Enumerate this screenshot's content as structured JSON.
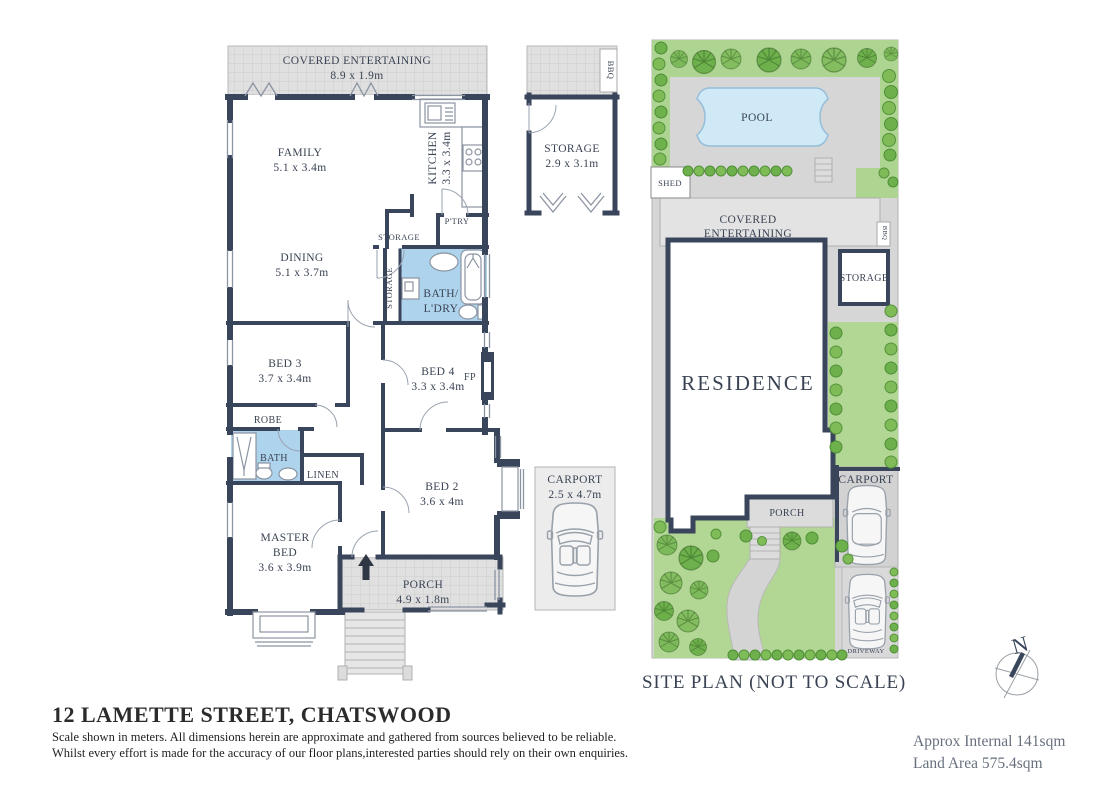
{
  "meta": {
    "address_title": "12 LAMETTE STREET, CHATSWOOD",
    "disclaimer_line1": "Scale shown in meters. All dimensions herein are approximate and gathered from sources believed to be reliable.",
    "disclaimer_line2": "Whilst every effort is made for the accuracy of our floor plans,interested parties should rely on their own enquiries.",
    "approx_internal": "Approx Internal 141sqm",
    "land_area": "Land Area 575.4sqm",
    "compass_north": "N"
  },
  "floorplan": {
    "covered_entertaining": {
      "name": "COVERED ENTERTAINING",
      "dims": "8.9 x 1.9m"
    },
    "family": {
      "name": "FAMILY",
      "dims": "5.1 x 3.4m"
    },
    "kitchen": {
      "name": "KITCHEN",
      "dims": "3.3 x 3.4m"
    },
    "pantry": {
      "name": "P'TRY"
    },
    "storage_hall": {
      "name": "STORAGE"
    },
    "storage_passage": {
      "name": "STORAGE"
    },
    "dining": {
      "name": "DINING",
      "dims": "5.1 x 3.7m"
    },
    "bath_laundry": {
      "line1": "BATH/",
      "line2": "L'DRY"
    },
    "bed3": {
      "name": "BED 3",
      "dims": "3.7 x 3.4m"
    },
    "bed4": {
      "name": "BED 4",
      "dims": "3.3 x 3.4m"
    },
    "fireplace": {
      "name": "FP"
    },
    "robe": {
      "name": "ROBE"
    },
    "bath": {
      "name": "BATH"
    },
    "linen": {
      "name": "LINEN"
    },
    "master_bed": {
      "line1": "MASTER",
      "line2": "BED",
      "dims": "3.6 x 3.9m"
    },
    "bed2": {
      "name": "BED 2",
      "dims": "3.6 x 4m"
    },
    "porch": {
      "name": "PORCH",
      "dims": "4.9 x 1.8m"
    },
    "external_storage": {
      "name": "STORAGE",
      "dims": "2.9 x 3.1m"
    },
    "bbq": {
      "name": "BBQ"
    },
    "carport": {
      "name": "CARPORT",
      "dims": "2.5 x 4.7m"
    }
  },
  "siteplan": {
    "caption": "SITE PLAN (NOT TO SCALE)",
    "pool": "POOL",
    "shed": "SHED",
    "covered_entertaining_line1": "COVERED",
    "covered_entertaining_line2": "ENTERTAINING",
    "bbq": "BBQ",
    "storage": "STORAGE",
    "residence": "RESIDENCE",
    "porch": "PORCH",
    "carport": "CARPORT",
    "driveway": "DRIVEWAY"
  },
  "colors": {
    "wall": "#39455a",
    "bath_blue": "#aed3ec",
    "pool_blue": "#cfe9f7",
    "paving_gray": "#e0e0e0",
    "site_gray": "#d6d6d6",
    "lawn_green": "#b2d795",
    "tree_green": "#7cb95a",
    "label": "#3a4353"
  }
}
